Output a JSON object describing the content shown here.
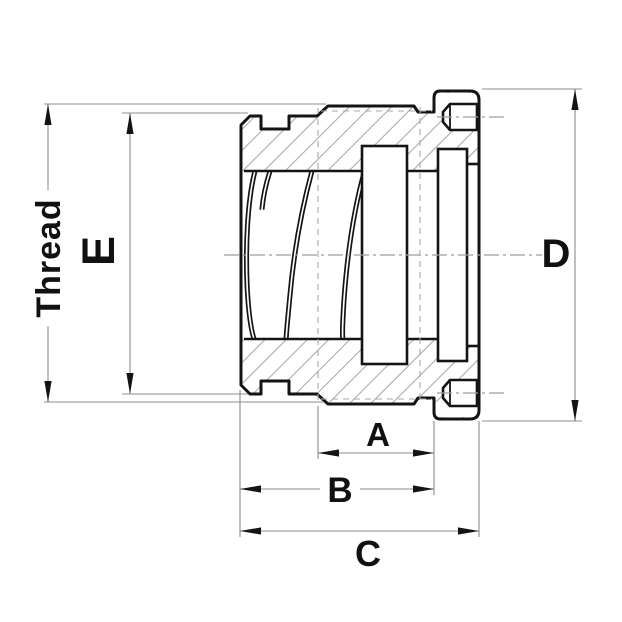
{
  "window": {
    "width": 622,
    "height": 622,
    "background": "#ffffff"
  },
  "drawing": {
    "kind": "engineering-cross-section-threaded-fitting",
    "labels": {
      "thread": "Thread",
      "e": "E",
      "d": "D",
      "a": "A",
      "b": "B",
      "c": "C"
    },
    "dimensions": [
      {
        "id": "thread",
        "label": "Thread",
        "orientation": "vertical",
        "side": "far-left"
      },
      {
        "id": "e",
        "label": "E",
        "orientation": "vertical",
        "side": "left"
      },
      {
        "id": "d",
        "label": "D",
        "orientation": "vertical",
        "side": "right"
      },
      {
        "id": "a",
        "label": "A",
        "orientation": "horizontal",
        "side": "bottom-first"
      },
      {
        "id": "b",
        "label": "B",
        "orientation": "horizontal",
        "side": "bottom-second"
      },
      {
        "id": "c",
        "label": "C",
        "orientation": "horizontal",
        "side": "bottom-third"
      }
    ],
    "colors": {
      "outline": "#141414",
      "thin_line": "#8d8d8d",
      "hatch": "#ababab",
      "construction": "#9e9e9e",
      "label_text": "#111111",
      "background": "#ffffff"
    }
  }
}
